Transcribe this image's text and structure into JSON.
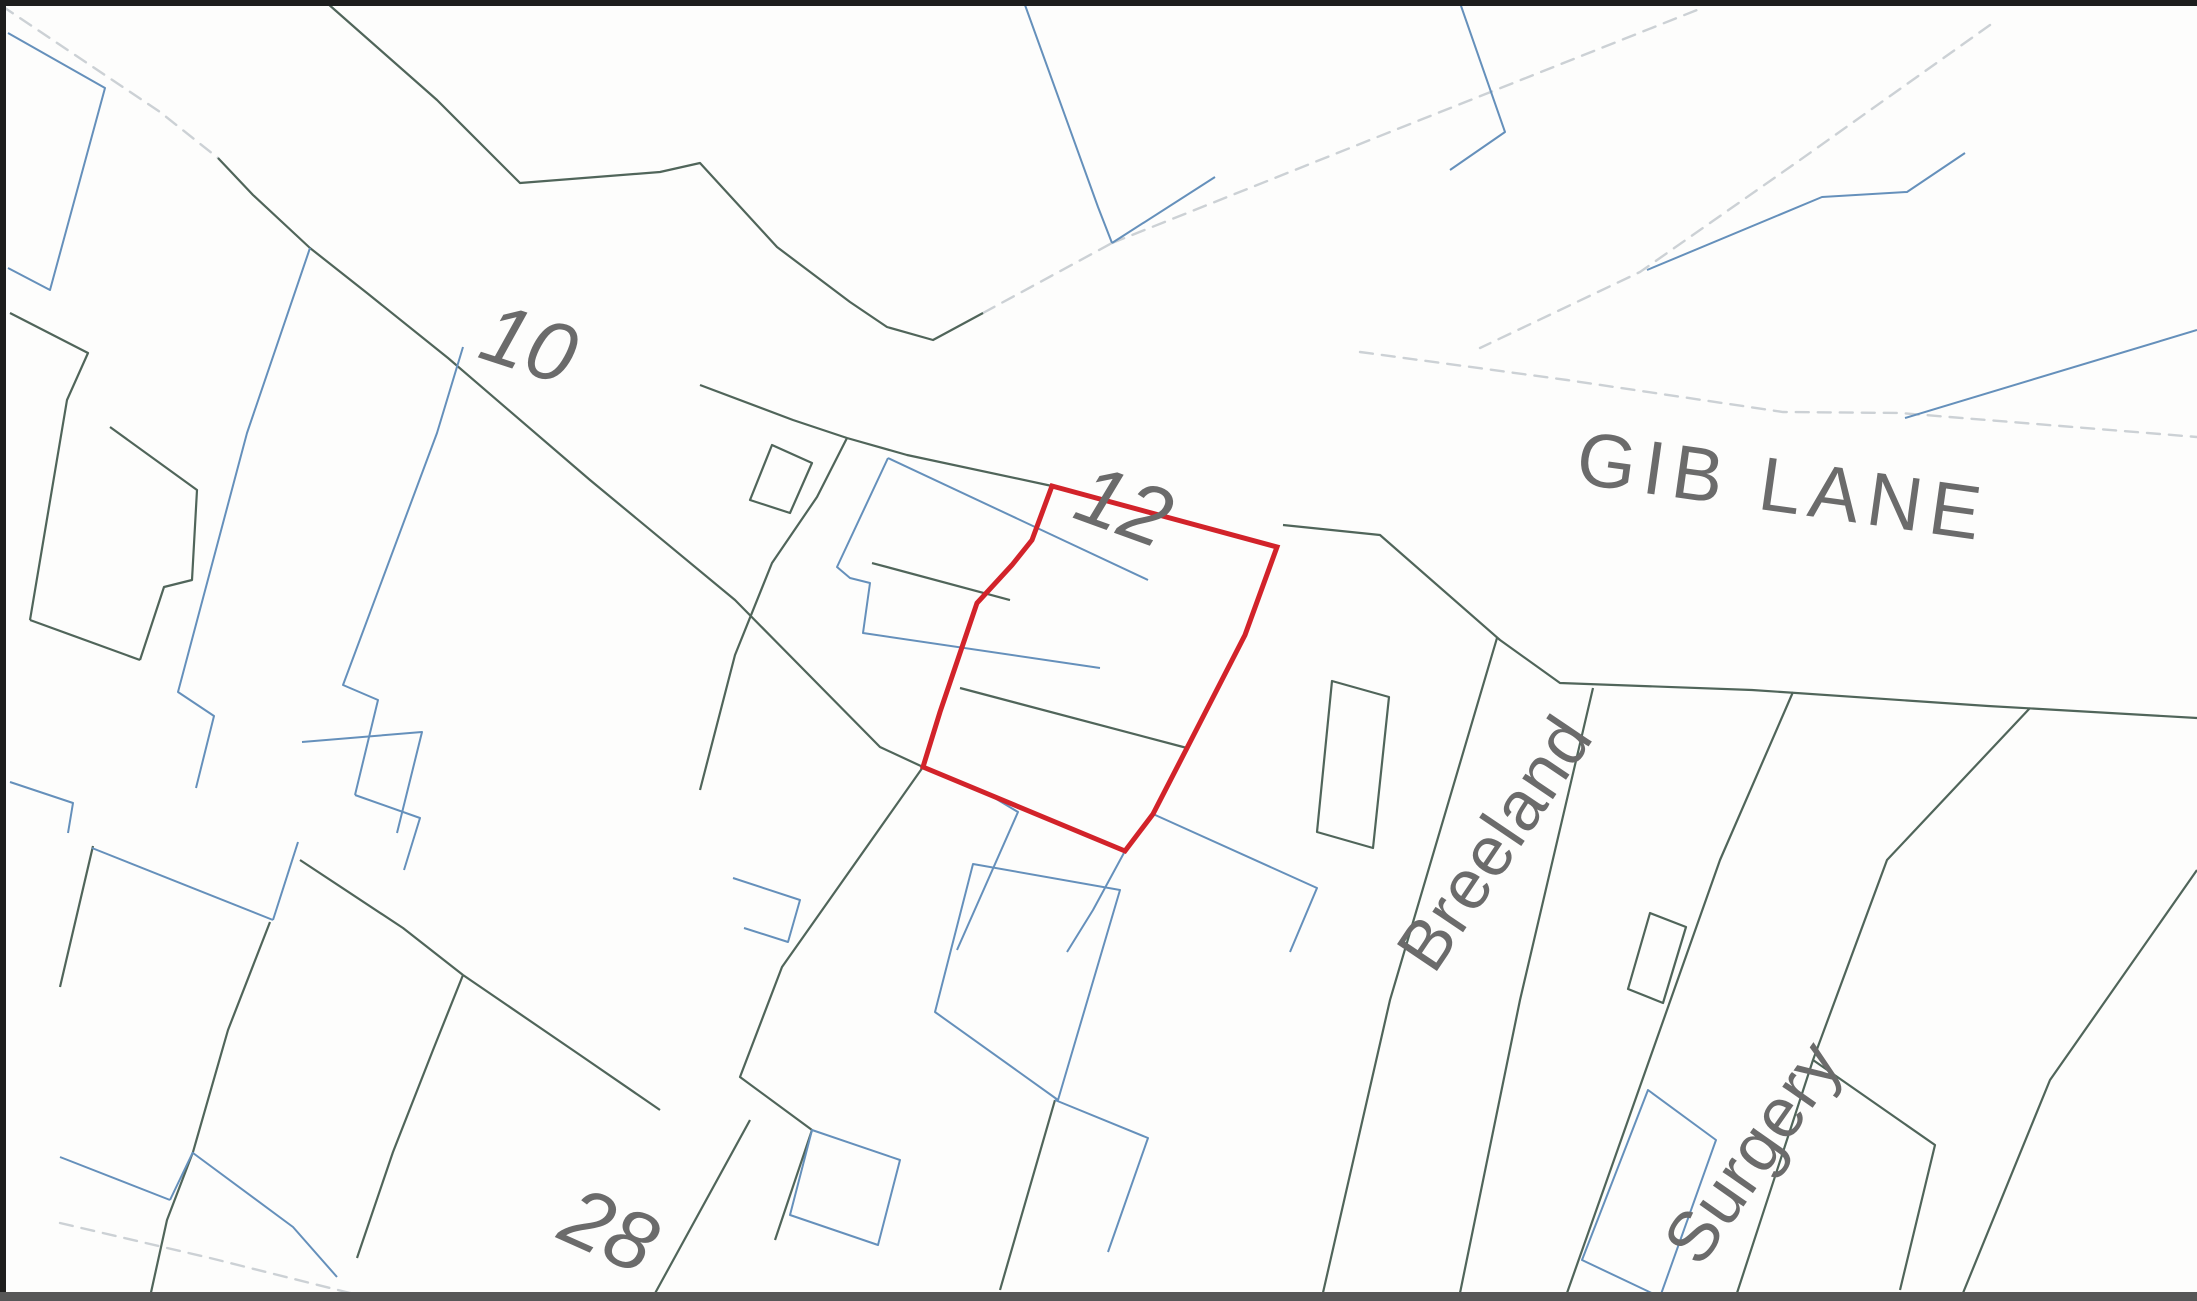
{
  "map": {
    "title": "Ordnance-survey style title plan extract",
    "canvas": {
      "width": 2197,
      "height": 1301
    },
    "colors": {
      "background": "#fdfdfc",
      "frame": "#1d1d1d",
      "frame_bottom": "#575757",
      "plot_red": "#d2232a",
      "parcel_green": "#50655a",
      "building_blue": "#6590bb",
      "road_gray": "#ccd1d5",
      "label_gray": "#6b6b6b"
    },
    "labels": {
      "house_10": {
        "text": "10",
        "x": 527,
        "y": 350,
        "rot": 18,
        "size": 84,
        "italic": true,
        "spacing": 0
      },
      "house_12": {
        "text": "12",
        "x": 1122,
        "y": 512,
        "rot": 20,
        "size": 84,
        "italic": true,
        "spacing": 0
      },
      "house_28": {
        "text": "28",
        "x": 607,
        "y": 1236,
        "rot": 24,
        "size": 84,
        "italic": true,
        "spacing": 0
      },
      "gib_lane": {
        "text": "GIB LANE",
        "x": 1782,
        "y": 492,
        "rot": 8,
        "size": 76,
        "italic": false,
        "spacing": 8
      },
      "breeland": {
        "text": "Breeland",
        "x": 1499,
        "y": 846,
        "rot": -56,
        "size": 70,
        "italic": false,
        "spacing": 1
      },
      "surgery": {
        "text": "Surgery",
        "x": 1757,
        "y": 1155,
        "rot": -55,
        "size": 70,
        "italic": false,
        "spacing": 1
      }
    },
    "subject_plot": {
      "name": "Plot at 12 Gib Lane (red edged)",
      "points": "1052,486 1277,547 1245,635 1187,748 1153,814 1125,851 923,767 940,712 977,603 1012,565 1032,540"
    },
    "layers": {
      "road_edges": [
        {
          "points": "2,6 160,112 218,158"
        },
        {
          "points": "983,313 1112,243"
        },
        {
          "points": "1112,243 1400,128 1697,10"
        },
        {
          "points": "1990,25 1800,160 1640,272 1480,348"
        },
        {
          "points": "1360,352 1567,380 1783,412 1900,413 2197,437"
        },
        {
          "points": "60,1223 210,1258 350,1293 560,1297"
        }
      ],
      "parcel_lines": [
        {
          "points": "218,158 253,195 310,248 367,293 448,358 590,480 735,600 880,747 923,767"
        },
        {
          "points": "923,767 782,967 740,1077 812,1130 775,1240"
        },
        {
          "points": "327,3 437,100 520,183 660,172 700,163 777,247 850,302 887,327 933,340 983,313"
        },
        {
          "points": "700,385 793,420 847,438 907,455 1052,486"
        },
        {
          "points": "1283,525 1380,535 1500,640 1560,683 1752,690 1988,706 2197,718"
        },
        {
          "points": "960,688 1187,748"
        },
        {
          "points": "872,563 1010,600"
        },
        {
          "points": "10,313 88,353 67,400 30,620"
        },
        {
          "points": "30,620 140,660"
        },
        {
          "points": "110,427 197,490 192,580 164,587 140,660"
        },
        {
          "points": "847,438 817,497 772,563 735,655 700,790"
        },
        {
          "points": "93,846 60,987"
        },
        {
          "points": "270,922 228,1030 193,1152 167,1220 150,1297"
        },
        {
          "points": "300,860 403,928 463,975"
        },
        {
          "points": "463,975 433,1050 393,1152 357,1258"
        },
        {
          "points": "463,975 580,1055 660,1110"
        },
        {
          "points": "750,1120 653,1297"
        },
        {
          "points": "1497,638 1390,1000 1322,1297"
        },
        {
          "points": "1593,688 1520,1000 1460,1293"
        },
        {
          "points": "1793,692 1720,860 1567,1293"
        },
        {
          "points": "2030,708 1887,860 1813,1060 1737,1293"
        },
        {
          "points": "1813,1060 1935,1145 1900,1290"
        },
        {
          "points": "2197,870 2050,1080 1963,1293"
        },
        {
          "points": "1055,1100 1000,1290"
        }
      ],
      "parcel_polygons": [
        {
          "points": "772,445 812,463 790,513 750,500"
        },
        {
          "points": "1332,681 1389,697 1373,848 1317,832"
        },
        {
          "points": "1650,913 1686,927 1663,1003 1628,989"
        }
      ],
      "building_lines": [
        {
          "points": "8,33 105,88 50,290 8,268"
        },
        {
          "points": "310,248 247,433 178,692 214,716 196,788"
        },
        {
          "points": "463,347 437,433 343,685 378,700 355,795"
        },
        {
          "points": "355,795 420,818 404,870"
        },
        {
          "points": "888,458 1148,580"
        },
        {
          "points": "888,458 837,567 850,578 870,583 863,633 1100,668"
        },
        {
          "points": "993,797 1018,812 957,950"
        },
        {
          "points": "1125,851 1093,910 1067,952"
        },
        {
          "points": "1153,814 1317,888 1290,952"
        },
        {
          "points": "733,878 800,900 788,942 744,928"
        },
        {
          "points": "1055,1100 1148,1138 1108,1252"
        },
        {
          "points": "1025,5 1098,207 1112,243"
        },
        {
          "points": "1112,243 1215,177"
        },
        {
          "points": "1460,3 1505,132 1450,170"
        },
        {
          "points": "1647,270 1822,197 1907,192 1965,153"
        },
        {
          "points": "1905,418 2197,330"
        },
        {
          "points": "10,782 73,803 68,833"
        },
        {
          "points": "302,742 422,732 397,833"
        },
        {
          "points": "92,848 273,920"
        },
        {
          "points": "273,920 298,842"
        },
        {
          "points": "60,1157 170,1200"
        },
        {
          "points": "170,1200 193,1152"
        },
        {
          "points": "193,1153 293,1227 337,1277"
        }
      ],
      "building_polygons": [
        {
          "points": "973,864 1120,890 1058,1100 935,1012"
        },
        {
          "points": "812,1130 900,1160 878,1245 790,1215"
        },
        {
          "points": "1648,1090 1716,1140 1660,1297 1582,1260"
        }
      ]
    }
  }
}
